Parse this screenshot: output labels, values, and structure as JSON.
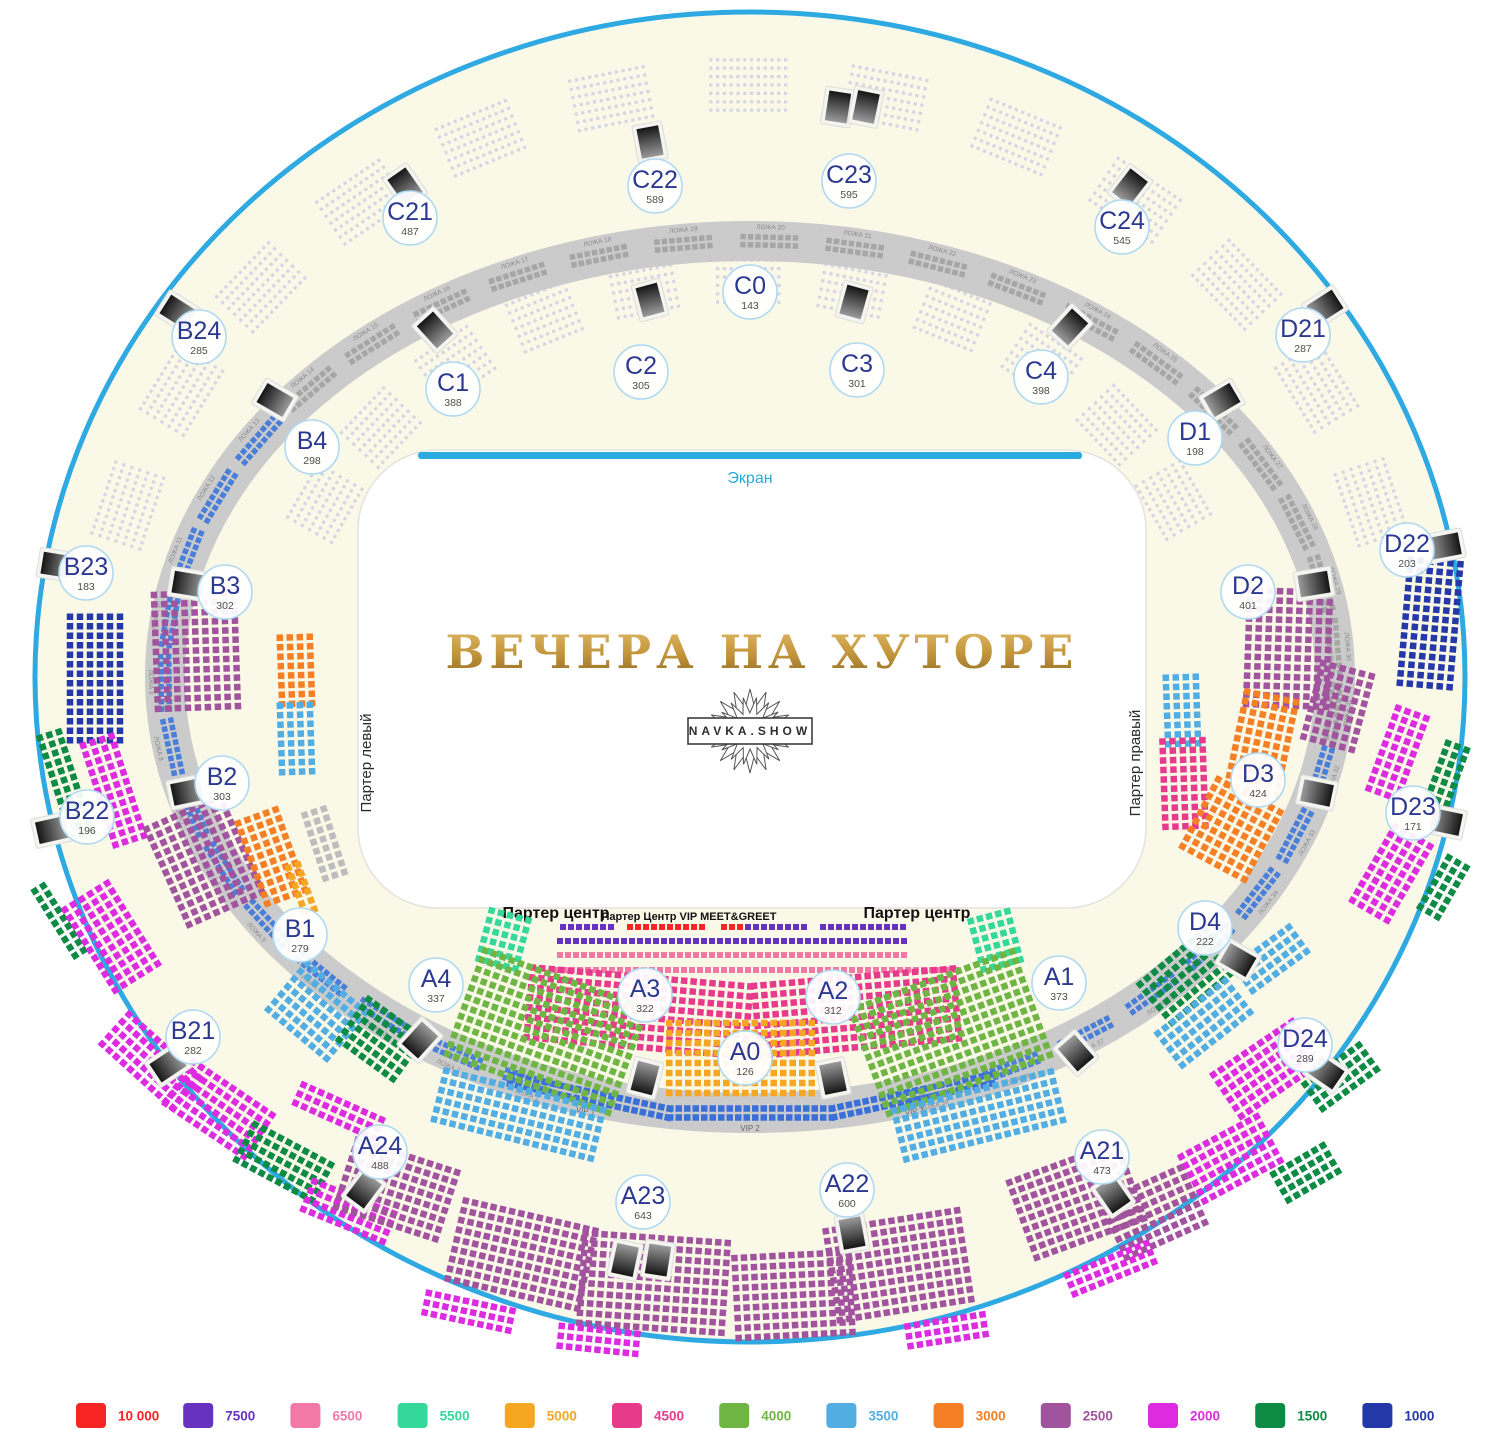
{
  "canvas": {
    "width": 1500,
    "height": 1429,
    "cx": 750,
    "cy": 677
  },
  "colors": {
    "page_bg": "#FFFFFF",
    "arena_fill": "#FAF8E7",
    "arena_stroke": "#2FA9E1",
    "band": "#CBCBCB",
    "field_fill": "#FFFFFF",
    "screen_bar": "#29ABE2",
    "section_code": "#2B3990",
    "faint_seat": "#D6D5E4",
    "gray_seat": "#BDBDBD",
    "lodge_seat": "#A6A6A6",
    "lodge_seat_blue": "#4A7FD9",
    "vip_seat": "#3A6FD8",
    "title_gold_top": "#E2BC68",
    "title_gold_bottom": "#8F6B22",
    "gate_dark": "#151515",
    "gate_light": "#9A9A9A"
  },
  "screen": {
    "label": "Экран"
  },
  "title": {
    "text": "ВЕЧЕРА НА ХУТОРЕ"
  },
  "logo": {
    "text": "NAVKA.SHOW"
  },
  "floor": {
    "left_label": "Партер левый",
    "right_label": "Партер правый",
    "center_left": "Партер центр",
    "center_right": "Партер центр",
    "vip_label": "Партер Центр VIP MEET&GREET"
  },
  "lodges": {
    "prefix": "ЛОЖА",
    "first": 1,
    "count": 39,
    "start_angle": 112,
    "step": 8.42,
    "rx": 585,
    "ry": 436,
    "blue_ranges": [
      [
        1,
        13
      ],
      [
        32,
        39
      ]
    ]
  },
  "vip_band": {
    "items": [
      {
        "label": "VIP 1",
        "angle": 106
      },
      {
        "label": "VIP 2",
        "angle": 90
      },
      {
        "label": "VIP 3",
        "angle": 74
      }
    ],
    "rows": 2,
    "cols": 20
  },
  "prices": [
    {
      "key": "10000",
      "label": "10 000",
      "color": "#F62423"
    },
    {
      "key": "7500",
      "label": "7500",
      "color": "#6733BE"
    },
    {
      "key": "6500",
      "label": "6500",
      "color": "#F279A6"
    },
    {
      "key": "5500",
      "label": "5500",
      "color": "#35D89B"
    },
    {
      "key": "5000",
      "label": "5000",
      "color": "#F5A623"
    },
    {
      "key": "4500",
      "label": "4500",
      "color": "#E83A8C"
    },
    {
      "key": "4000",
      "label": "4000",
      "color": "#6FB544"
    },
    {
      "key": "3500",
      "label": "3500",
      "color": "#52AEE2"
    },
    {
      "key": "3000",
      "label": "3000",
      "color": "#F57F25"
    },
    {
      "key": "2500",
      "label": "2500",
      "color": "#A1539E"
    },
    {
      "key": "2000",
      "label": "2000",
      "color": "#DD2BE0"
    },
    {
      "key": "1500",
      "label": "1500",
      "color": "#0D8A44"
    },
    {
      "key": "1000",
      "label": "1000",
      "color": "#2438A8"
    }
  ],
  "legend": {
    "x0": 76,
    "step": 107.2,
    "y": 1403,
    "sw": 30,
    "sh": 25
  },
  "sections": [
    [
      "C21",
      "487",
      410,
      218
    ],
    [
      "C22",
      "589",
      655,
      186
    ],
    [
      "C23",
      "595",
      849,
      181
    ],
    [
      "C24",
      "545",
      1122,
      227
    ],
    [
      "C0",
      "143",
      750,
      292
    ],
    [
      "C1",
      "388",
      453,
      389
    ],
    [
      "C2",
      "305",
      641,
      372
    ],
    [
      "C3",
      "301",
      857,
      370
    ],
    [
      "C4",
      "398",
      1041,
      377
    ],
    [
      "B24",
      "285",
      199,
      337
    ],
    [
      "B4",
      "298",
      312,
      447
    ],
    [
      "D1",
      "198",
      1195,
      438
    ],
    [
      "D21",
      "287",
      1303,
      335
    ],
    [
      "B23",
      "183",
      86,
      573
    ],
    [
      "B3",
      "302",
      225,
      592
    ],
    [
      "B22",
      "196",
      87,
      817
    ],
    [
      "B2",
      "303",
      222,
      783
    ],
    [
      "B21",
      "282",
      193,
      1037
    ],
    [
      "B1",
      "279",
      300,
      935
    ],
    [
      "D2",
      "401",
      1248,
      592
    ],
    [
      "D22",
      "203",
      1407,
      550
    ],
    [
      "D3",
      "424",
      1258,
      780
    ],
    [
      "D23",
      "171",
      1413,
      813
    ],
    [
      "D4",
      "222",
      1205,
      928
    ],
    [
      "D24",
      "289",
      1305,
      1045
    ],
    [
      "A4",
      "337",
      436,
      985
    ],
    [
      "A3",
      "322",
      645,
      995
    ],
    [
      "A0",
      "126",
      745,
      1058
    ],
    [
      "A2",
      "312",
      833,
      997
    ],
    [
      "A1",
      "373",
      1059,
      983
    ],
    [
      "A24",
      "488",
      380,
      1152
    ],
    [
      "A23",
      "643",
      643,
      1202
    ],
    [
      "A22",
      "600",
      847,
      1190
    ],
    [
      "A21",
      "473",
      1102,
      1157
    ]
  ],
  "faint_arcs": [
    {
      "rx": 650,
      "ry": 592,
      "a0": 197,
      "a1": 343,
      "n": 13,
      "rows": 7,
      "cols": 12
    },
    {
      "rx": 472,
      "ry": 400,
      "a0": 206,
      "a1": 334,
      "n": 11,
      "rows": 7,
      "cols": 10
    }
  ],
  "seat_blocks": [
    [
      95,
      680,
      90,
      6,
      14,
      "1000"
    ],
    [
      66,
      786,
      72,
      3,
      12,
      "1500"
    ],
    [
      114,
      792,
      72,
      4,
      12,
      "2000"
    ],
    [
      60,
      922,
      58,
      2,
      9,
      "1500"
    ],
    [
      112,
      938,
      58,
      6,
      11,
      "2000"
    ],
    [
      152,
      1062,
      42,
      5,
      11,
      "2000"
    ],
    [
      220,
      1110,
      34,
      6,
      11,
      "2000"
    ],
    [
      285,
      1163,
      28,
      5,
      10,
      "1500"
    ],
    [
      350,
      1212,
      22,
      4,
      10,
      "2000"
    ],
    [
      340,
      1112,
      24,
      3,
      10,
      "2000"
    ],
    [
      398,
      1190,
      18,
      8,
      12,
      "2500"
    ],
    [
      523,
      1255,
      13,
      9,
      15,
      "2500"
    ],
    [
      470,
      1312,
      12,
      3,
      10,
      "2000"
    ],
    [
      655,
      1283,
      4,
      10,
      16,
      "2500"
    ],
    [
      600,
      1340,
      6,
      3,
      9,
      "2000"
    ],
    [
      795,
      1295,
      -3,
      9,
      13,
      "2500"
    ],
    [
      900,
      1265,
      -9,
      10,
      15,
      "2500"
    ],
    [
      948,
      1330,
      -9,
      3,
      9,
      "2000"
    ],
    [
      1078,
      1200,
      -20,
      9,
      13,
      "2500"
    ],
    [
      1155,
      1212,
      -24,
      7,
      10,
      "2500"
    ],
    [
      1112,
      1268,
      -22,
      3,
      10,
      "2000"
    ],
    [
      1268,
      1068,
      -34,
      6,
      11,
      "2000"
    ],
    [
      1342,
      1076,
      -36,
      4,
      8,
      "1500"
    ],
    [
      1232,
      1158,
      -28,
      6,
      10,
      "2000"
    ],
    [
      1307,
      1172,
      -30,
      4,
      7,
      "1500"
    ],
    [
      1398,
      752,
      -70,
      4,
      10,
      "2000"
    ],
    [
      1448,
      772,
      -70,
      3,
      7,
      "1500"
    ],
    [
      1392,
      872,
      -60,
      5,
      10,
      "2000"
    ],
    [
      1444,
      886,
      -60,
      3,
      7,
      "1500"
    ],
    [
      1430,
      625,
      95,
      6,
      14,
      "1000"
    ],
    [
      196,
      652,
      88,
      9,
      13,
      "2500"
    ],
    [
      296,
      672,
      88,
      4,
      8,
      "3000"
    ],
    [
      296,
      740,
      88,
      4,
      8,
      "3500"
    ],
    [
      205,
      862,
      66,
      9,
      12,
      "2500"
    ],
    [
      272,
      858,
      70,
      5,
      10,
      "3000"
    ],
    [
      325,
      845,
      72,
      3,
      8,
      "gray"
    ],
    [
      302,
      890,
      70,
      2,
      6,
      "5000"
    ],
    [
      318,
      1012,
      40,
      7,
      9,
      "3500"
    ],
    [
      382,
      1040,
      36,
      6,
      8,
      "1500"
    ],
    [
      1288,
      650,
      92,
      9,
      13,
      "2500"
    ],
    [
      1182,
      712,
      88,
      4,
      8,
      "3500"
    ],
    [
      1184,
      785,
      88,
      5,
      10,
      "4500"
    ],
    [
      1338,
      705,
      -75,
      6,
      9,
      "2500"
    ],
    [
      1262,
      742,
      -78,
      6,
      11,
      "3000"
    ],
    [
      1232,
      828,
      -62,
      8,
      9,
      "3000"
    ],
    [
      1190,
      975,
      -40,
      6,
      10,
      "1500"
    ],
    [
      1205,
      1022,
      -38,
      5,
      10,
      "3500"
    ],
    [
      1272,
      958,
      -36,
      4,
      8,
      "3500"
    ],
    [
      588,
      927,
      0,
      1,
      7,
      "7500",
      8,
      6,
      8
    ],
    [
      667,
      927,
      0,
      1,
      10,
      "10000",
      8,
      6,
      8
    ],
    [
      733,
      927,
      0,
      1,
      3,
      "10000",
      8,
      6,
      8
    ],
    [
      777,
      927,
      0,
      1,
      8,
      "7500",
      8,
      6,
      8
    ],
    [
      864,
      927,
      0,
      1,
      11,
      "7500",
      8,
      6,
      8
    ],
    [
      733,
      941,
      0,
      1,
      44,
      "7500",
      8,
      6,
      8
    ],
    [
      733,
      955,
      0,
      1,
      44,
      "6500",
      8,
      6,
      8
    ],
    [
      757,
      970,
      0,
      1,
      51,
      "6500",
      8,
      6,
      8
    ],
    [
      505,
      940,
      15,
      6,
      5,
      "5500"
    ],
    [
      997,
      940,
      -15,
      6,
      5,
      "5500"
    ],
    [
      640,
      1012,
      5,
      8,
      24,
      "4500"
    ],
    [
      858,
      1012,
      -5,
      8,
      22,
      "4500"
    ],
    [
      742,
      1058,
      0,
      8,
      16,
      "5000"
    ],
    [
      548,
      1032,
      20,
      12,
      19,
      "4000"
    ],
    [
      520,
      1115,
      14,
      6,
      18,
      "3500"
    ],
    [
      952,
      1032,
      -20,
      12,
      19,
      "4000"
    ],
    [
      980,
      1115,
      -14,
      6,
      18,
      "3500"
    ]
  ],
  "gates": [
    [
      650,
      142
    ],
    [
      838,
      107
    ],
    [
      866,
      107
    ],
    [
      405,
      186
    ],
    [
      1130,
      187
    ],
    [
      178,
      312
    ],
    [
      1325,
      307
    ],
    [
      275,
      400
    ],
    [
      1222,
      400
    ],
    [
      650,
      300
    ],
    [
      854,
      302
    ],
    [
      1070,
      327
    ],
    [
      435,
      330
    ],
    [
      57,
      565
    ],
    [
      188,
      584
    ],
    [
      1445,
      546
    ],
    [
      1314,
      584
    ],
    [
      52,
      830
    ],
    [
      187,
      792
    ],
    [
      1446,
      822
    ],
    [
      1317,
      793
    ],
    [
      168,
      1065
    ],
    [
      364,
      1190
    ],
    [
      420,
      1040
    ],
    [
      625,
      1260
    ],
    [
      658,
      1260
    ],
    [
      852,
      1233
    ],
    [
      1238,
      960
    ],
    [
      1076,
      1053
    ],
    [
      1326,
      1072
    ],
    [
      1113,
      1195
    ],
    [
      645,
      1078
    ],
    [
      833,
      1078
    ]
  ]
}
